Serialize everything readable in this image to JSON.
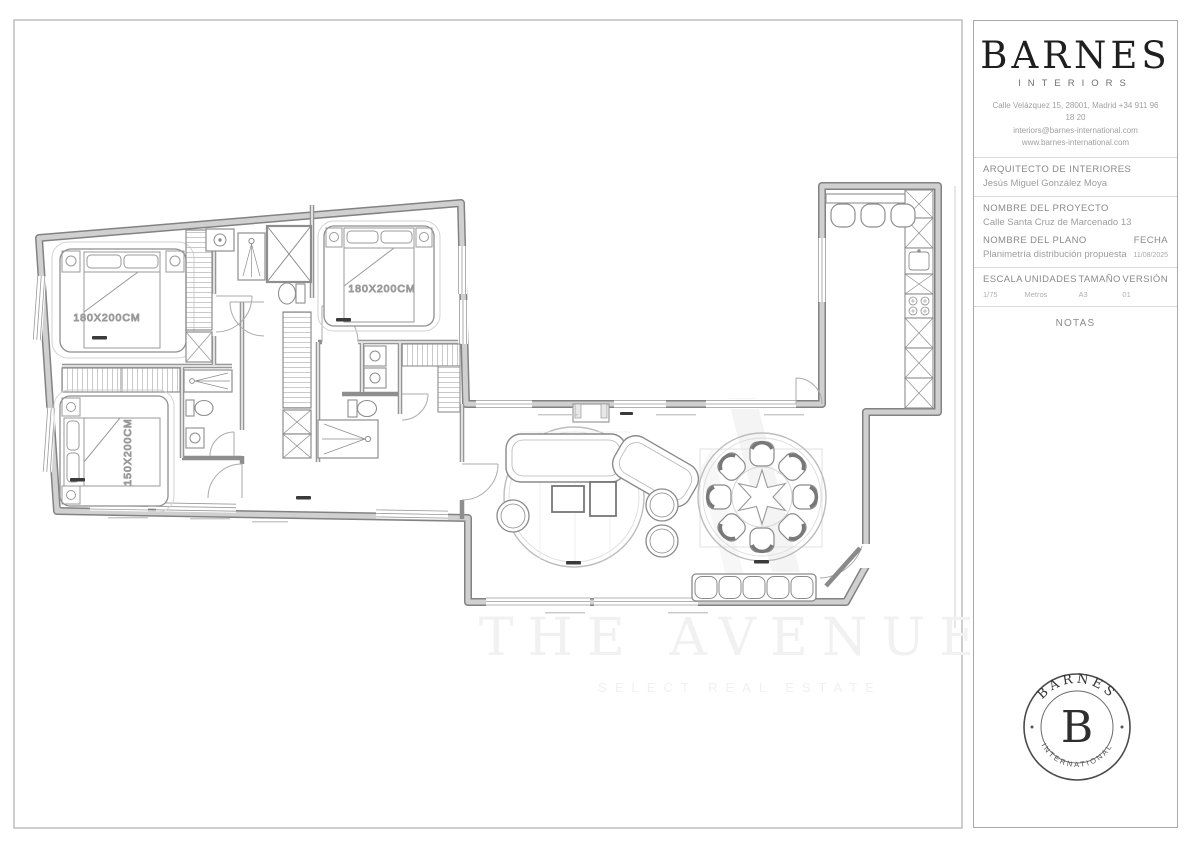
{
  "title_block": {
    "brand": {
      "name": "BARNES",
      "subtitle": "INTERIORS"
    },
    "contact": {
      "line1": "Calle Velázquez 15, 28001, Madrid +34 911 96",
      "line2": "18 20",
      "line3": "interiors@barnes-international.com",
      "line4": "www.barnes-international.com"
    },
    "architect": {
      "label": "ARQUITECTO DE INTERIORES",
      "value": "Jesús Miguel González Moya"
    },
    "project": {
      "label": "NOMBRE DEL PROYECTO",
      "value": "Calle Santa Cruz de Marcenado 13"
    },
    "plan": {
      "label": "NOMBRE DEL PLANO",
      "value": "Planimetría distribución propuesta"
    },
    "date": {
      "label": "FECHA",
      "value": "11/08/2025"
    },
    "specs": [
      {
        "label": "ESCALA",
        "value": "1/75"
      },
      {
        "label": "UNIDADES",
        "value": "Metros"
      },
      {
        "label": "TAMAÑO",
        "value": "A3"
      },
      {
        "label": "VERSIÓN",
        "value": "01"
      }
    ],
    "notes_label": "NOTAS"
  },
  "floor_plan": {
    "bed_labels": {
      "bedroom1": "180X200CM",
      "bedroom2": "180X200CM",
      "bedroom3": "150X200CM"
    }
  },
  "watermark": {
    "title": "THE AVENUE",
    "subtitle": "SELECT REAL ESTATE"
  },
  "stamp": {
    "arc_top": "BARNES",
    "monogram": "B",
    "arc_bottom": "INTERNATIONAL"
  },
  "colors": {
    "wall_edge": "#828282",
    "wall_fill": "#d0d0d0",
    "accent_dark": "#1f1f1f"
  }
}
